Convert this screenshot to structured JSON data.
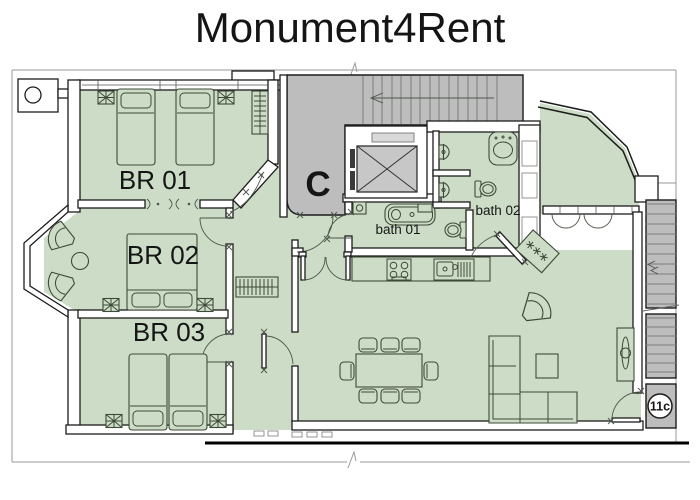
{
  "title": "Monument4Rent",
  "floorplan": {
    "rooms": {
      "bedroom1": {
        "label": "BR 01"
      },
      "bedroom2": {
        "label": "BR 02"
      },
      "bedroom3": {
        "label": "BR 03"
      },
      "bathroom1": {
        "label": "bath 01"
      },
      "bathroom2": {
        "label": "bath 02"
      },
      "stairwell": {
        "label": "C"
      },
      "unit_door": {
        "label": "11c"
      }
    },
    "colors": {
      "room": "#ccdcc6",
      "gray": "#bdbdbd",
      "wall": "#1c1c1c",
      "furn": "#3e4a38",
      "boundary": "#9a9a9a",
      "titlecolor": "#111111"
    }
  }
}
